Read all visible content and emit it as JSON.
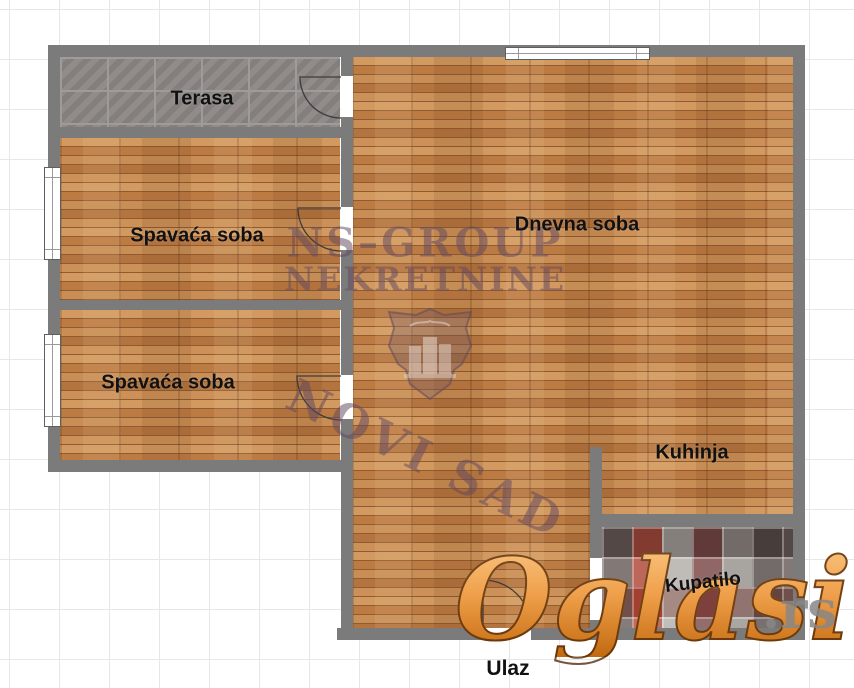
{
  "floorplan": {
    "rooms": [
      {
        "name": "terrace",
        "label": "Terasa"
      },
      {
        "name": "bedroom-1",
        "label": "Spavaća soba"
      },
      {
        "name": "bedroom-2",
        "label": "Spavaća soba"
      },
      {
        "name": "living-room",
        "label": "Dnevna soba"
      },
      {
        "name": "kitchen",
        "label": "Kuhinja"
      },
      {
        "name": "bathroom",
        "label": "Kupatilo"
      }
    ],
    "entrance_label": "Ulaz"
  },
  "watermarks": {
    "agency_line1": "NS–GROUP",
    "agency_line2": "NEKRETNINE",
    "agency_city": "NOVI SAD",
    "portal_brand": "Oglasi",
    "portal_tld": ".rs"
  },
  "colors": {
    "wall_gray": "#7b7b7b",
    "wood_floor": "#c6854d",
    "terrace_tile": "#8b8683",
    "watermark_purple": "#62485f",
    "portal_orange": "#e8923c",
    "label_text": "#111111"
  }
}
